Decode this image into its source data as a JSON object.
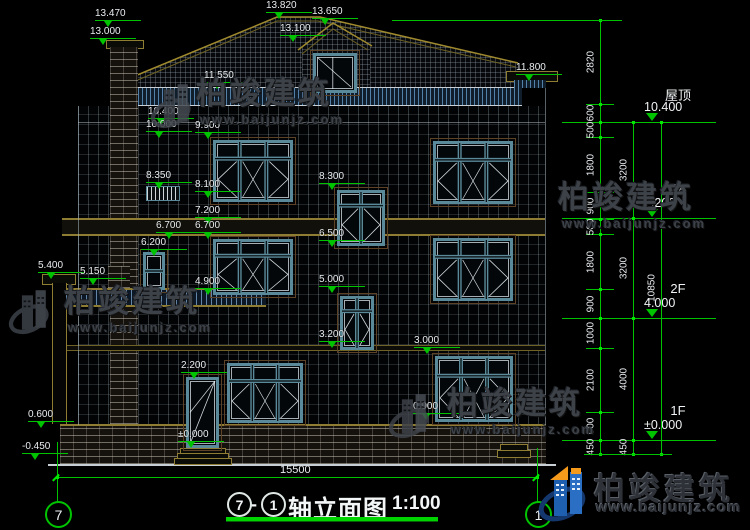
{
  "title": {
    "bubble_left": "7",
    "dash": "-",
    "bubble_right": "1",
    "name": "轴立面图",
    "scale": "1:100"
  },
  "bottom_dim": {
    "value": "15500"
  },
  "axis": {
    "left": "7",
    "right": "1"
  },
  "floors": [
    {
      "label": "屋顶",
      "elev": "10.400",
      "y": 122
    },
    {
      "label": "3F",
      "elev": "7.200",
      "y": 218
    },
    {
      "label": "2F",
      "elev": "4.000",
      "y": 318
    },
    {
      "label": "1F",
      "elev": "±0.000",
      "y": 440
    }
  ],
  "elevation_markers": [
    {
      "v": "13.470",
      "x": 95,
      "y": 9
    },
    {
      "v": "13.000",
      "x": 90,
      "y": 27
    },
    {
      "v": "13.820",
      "x": 266,
      "y": 1
    },
    {
      "v": "13.650",
      "x": 312,
      "y": 7
    },
    {
      "v": "13.100",
      "x": 280,
      "y": 24
    },
    {
      "v": "11.550",
      "x": 204,
      "y": 71
    },
    {
      "v": "11.800",
      "x": 516,
      "y": 63
    },
    {
      "v": "10.400",
      "x": 148,
      "y": 107
    },
    {
      "v": "10.000",
      "x": 146,
      "y": 120
    },
    {
      "v": "9.900",
      "x": 195,
      "y": 121
    },
    {
      "v": "8.350",
      "x": 146,
      "y": 171
    },
    {
      "v": "8.100",
      "x": 195,
      "y": 180
    },
    {
      "v": "8.300",
      "x": 319,
      "y": 172
    },
    {
      "v": "7.200",
      "x": 195,
      "y": 206
    },
    {
      "v": "6.700",
      "x": 156,
      "y": 221
    },
    {
      "v": "6.700",
      "x": 195,
      "y": 221
    },
    {
      "v": "6.500",
      "x": 319,
      "y": 229
    },
    {
      "v": "6.200",
      "x": 141,
      "y": 238
    },
    {
      "v": "5.400",
      "x": 38,
      "y": 261
    },
    {
      "v": "5.150",
      "x": 80,
      "y": 267
    },
    {
      "v": "5.000",
      "x": 319,
      "y": 275
    },
    {
      "v": "4.900",
      "x": 195,
      "y": 277
    },
    {
      "v": "3.200",
      "x": 319,
      "y": 330
    },
    {
      "v": "3.000",
      "x": 414,
      "y": 336
    },
    {
      "v": "2.200",
      "x": 181,
      "y": 361
    },
    {
      "v": "0.900",
      "x": 413,
      "y": 402
    },
    {
      "v": "0.600",
      "x": 28,
      "y": 410
    },
    {
      "v": "±0.000",
      "x": 178,
      "y": 430
    },
    {
      "v": "-0.450",
      "x": 22,
      "y": 442
    }
  ],
  "dim_chains": [
    {
      "x": 600,
      "y1": 20,
      "y2": 454,
      "boundaries": [
        20,
        104,
        122,
        137,
        192,
        219,
        234,
        289,
        318,
        348,
        412,
        440,
        454
      ],
      "ticks": [
        20,
        104,
        137,
        192,
        219,
        234,
        289,
        348,
        412
      ],
      "segments": [
        {
          "v": "2820",
          "mid": 62
        },
        {
          "v": "600",
          "mid": 113
        },
        {
          "v": "500",
          "mid": 130
        },
        {
          "v": "1800",
          "mid": 165
        },
        {
          "v": "900",
          "mid": 206
        },
        {
          "v": "500",
          "mid": 227
        },
        {
          "v": "1800",
          "mid": 262
        },
        {
          "v": "900",
          "mid": 304
        },
        {
          "v": "1000",
          "mid": 333
        },
        {
          "v": "2100",
          "mid": 380
        },
        {
          "v": "900",
          "mid": 426
        },
        {
          "v": "450",
          "mid": 447
        }
      ]
    },
    {
      "x": 633,
      "y1": 122,
      "y2": 454,
      "boundaries": [
        122,
        218,
        318,
        440,
        454
      ],
      "ticks": [],
      "segments": [
        {
          "v": "3200",
          "mid": 170
        },
        {
          "v": "3200",
          "mid": 268
        },
        {
          "v": "4000",
          "mid": 379
        },
        {
          "v": "450",
          "mid": 447
        }
      ]
    },
    {
      "x": 661,
      "y1": 122,
      "y2": 454,
      "boundaries": [
        122,
        454
      ],
      "ticks": [],
      "segments": [
        {
          "v": "10850",
          "mid": 288
        }
      ]
    }
  ],
  "watermarks": {
    "brand": "柏竣建筑",
    "url": "www.baijunjz.com",
    "instances": [
      {
        "x": 196,
        "y": 78,
        "glyph": true,
        "gx": 150,
        "gy": 74
      },
      {
        "x": 558,
        "y": 182,
        "glyph": false,
        "gx": 0,
        "gy": 0
      },
      {
        "x": 64,
        "y": 286,
        "glyph": true,
        "gx": 8,
        "gy": 280
      },
      {
        "x": 447,
        "y": 388,
        "glyph": true,
        "gx": 388,
        "gy": 384
      }
    ]
  },
  "logo": {
    "brand": "柏竣建筑",
    "url": "www.baijunjz.com"
  },
  "colors": {
    "dim_green": "#00c300",
    "text": "#e9edf0",
    "olive": "#8f7d33",
    "teal": "#5a8a99",
    "watermark": "#3d4249",
    "logo_blue": "#1f5fb0",
    "logo_orange": "#f59a1b"
  }
}
